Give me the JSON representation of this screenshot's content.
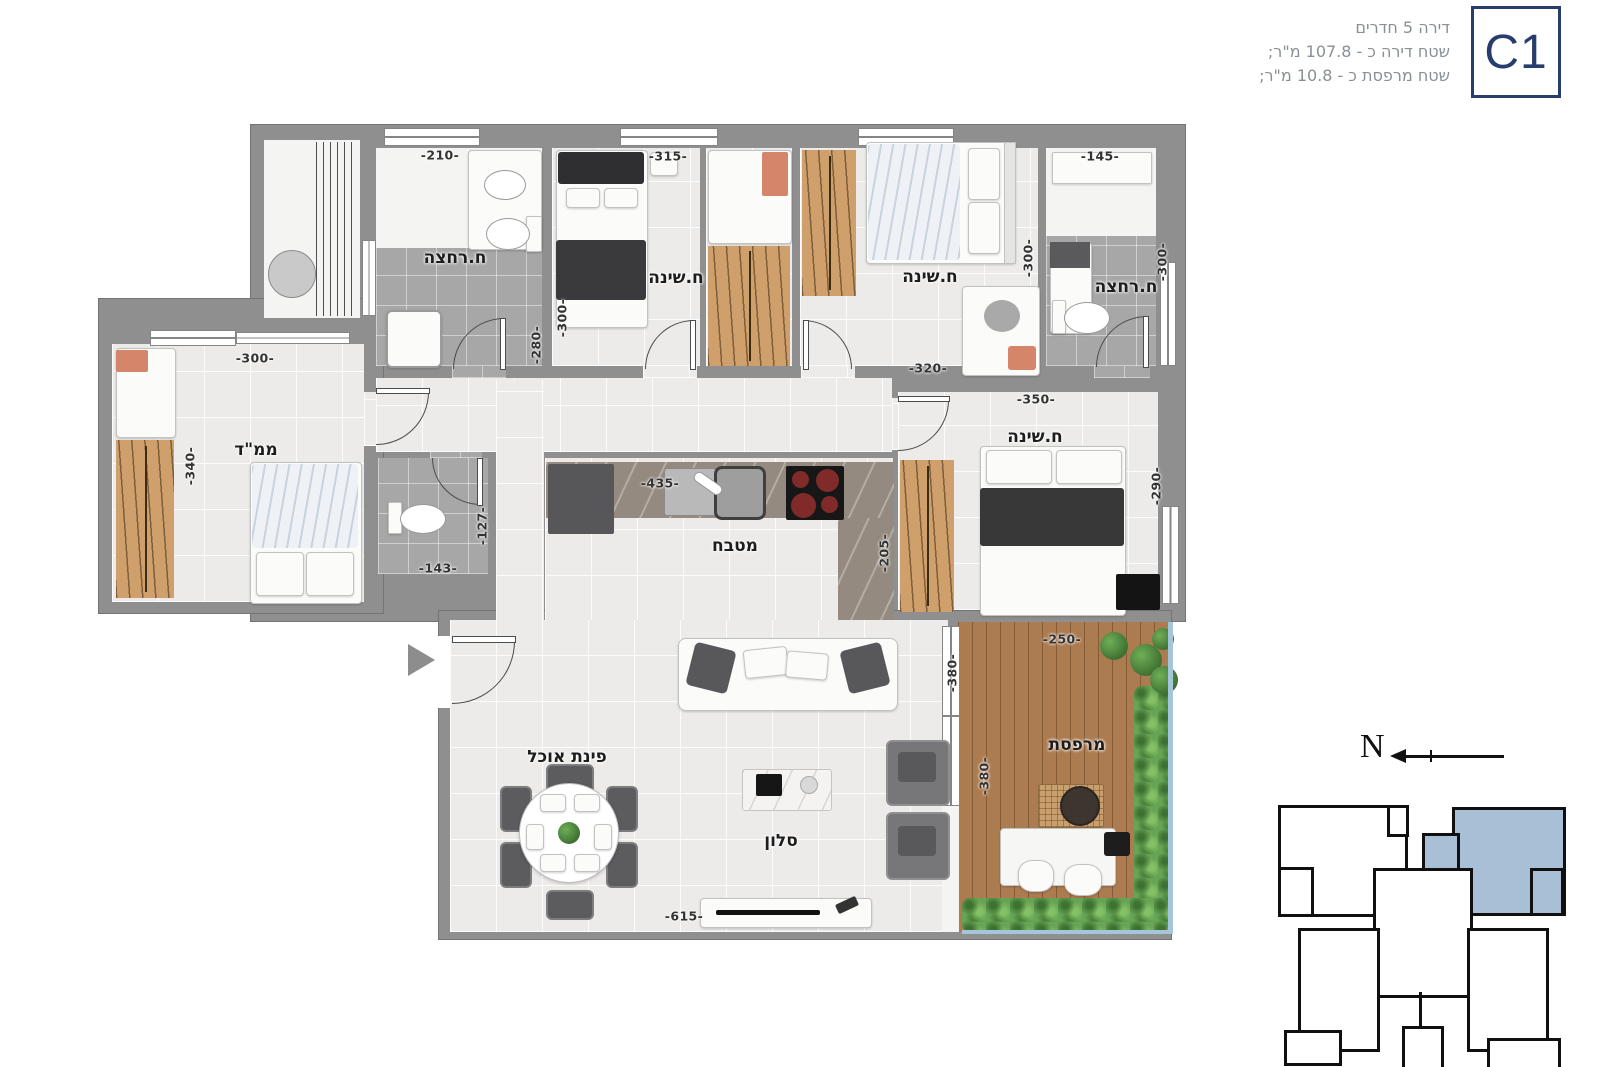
{
  "header": {
    "unit_code": "C1",
    "line1": "דירה 5 חדרים",
    "line2": "שטח דירה כ - 107.8 מ\"ר;",
    "line3": "שטח מרפסת כ - 10.8 מ\"ר;"
  },
  "compass": {
    "north": "N"
  },
  "rooms": {
    "bath1": "ח.רחצה",
    "bed1": "ח.שינה",
    "bed2": "ח.שינה",
    "bath2": "ח.רחצה",
    "mamad": "ממ\"ד",
    "kitchen": "מטבח",
    "master": "ח.שינה",
    "dining": "פינת אוכל",
    "salon": "סלון",
    "balcony": "מרפסת"
  },
  "dims": {
    "bath1_w": "-210-",
    "bed1_w": "-315-",
    "bath2_w": "-145-",
    "bed1_h": "-300-",
    "bath1_h": "-280-",
    "bed2_h": "-300-",
    "bath2_h": "-300-",
    "bed2_w": "-320-",
    "master_w": "-350-",
    "mamad_w": "-300-",
    "mamad_h": "-340-",
    "wc_h": "-127-",
    "wc_w": "-143-",
    "kitchen_w": "-435-",
    "kitchen_h": "-205-",
    "master_h": "-290-",
    "balcony_w": "-250-",
    "living_h": "-380-",
    "balcony_h": "-380-",
    "living_w": "-615-"
  },
  "colors": {
    "accent_navy": "#273d6d",
    "wall_gray": "#8f8f8f",
    "unit_highlight": "#a9bfd5"
  }
}
